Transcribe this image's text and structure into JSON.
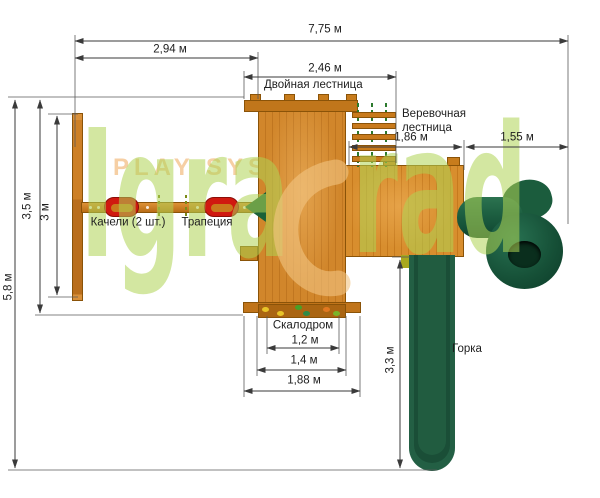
{
  "watermark": {
    "play_system": "PLAY SYSTEM",
    "brand_left": "Igra",
    "brand_right": "rad"
  },
  "structure_labels": {
    "double_ladder": "Двойная лестница",
    "rope_ladder_line1": "Веревочная",
    "rope_ladder_line2": "лестница",
    "swings": "Качели (2 шт.)",
    "trapeze": "Трапеция",
    "climbing_wall": "Скалодром",
    "slide": "Горка"
  },
  "dimensions": {
    "total_width": "7,75 м",
    "left_span": "2,94 м",
    "platform_span": "2,46 м",
    "rope_ladder_span": "1,86 м",
    "right_span": "1,55 м",
    "total_depth": "5,8 м",
    "swing_depth": "3,5 м",
    "beam_span": "3 м",
    "slide_length": "3,3 м",
    "climb_width_inner": "1,2 м",
    "climb_width_mid": "1,4 м",
    "climb_width_outer": "1,88 м"
  },
  "colors": {
    "wood": "#d1862b",
    "wood-dark": "#c07620",
    "seat-red": "#d01910",
    "rope-green": "#2c7a2e",
    "slide-green": "#235f44",
    "wm-green": "#aed454",
    "wm-peach": "#f6cfa4",
    "dim-line": "#3a3a3a"
  }
}
